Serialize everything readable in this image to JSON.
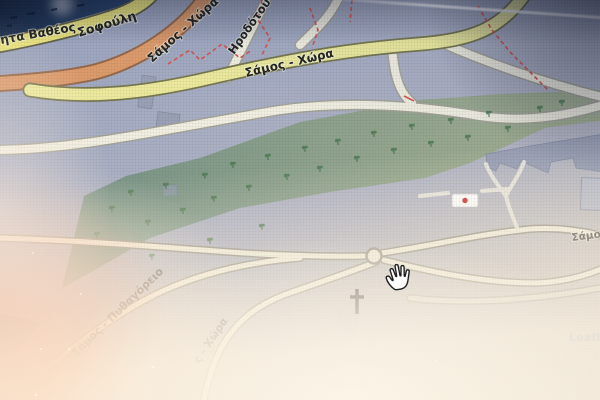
{
  "map": {
    "attribution": "Leaflet",
    "cursor": "open-hand-grab",
    "labels": {
      "coast_partial": "ητα Βαθέος",
      "sofouli": "Σοφούλη",
      "primary_road": "Σάμος - Χώρα",
      "irodotou": "Ηροδότου",
      "secondary_road": "Σάμος - Χώρα",
      "samos_edge": "Σάμος",
      "pythagoreio_road": "Σάμος - Πυθαγόρειο",
      "chora_partial": "ς - Χώρα"
    },
    "colors": {
      "water": "#2e4a78",
      "water_deep": "#14223d",
      "road_coast": "#e9e27e",
      "road_coast_casing": "#5f5f47",
      "road_primary": "#dd9a6b",
      "road_primary_casing": "#96684a",
      "road_secondary": "#edea9d",
      "road_secondary_casing": "#77774f",
      "road_minor": "#f2efe2",
      "road_minor_casing": "#a5a49a",
      "forest_dark": "#568060",
      "forest_light": "#99ad66",
      "building": "#9aa0b6",
      "path_red": "#d9534f",
      "poi_marker_red": "#cc2222",
      "cross_black": "#1c1c1c",
      "attribution_blue": "#7b8fd4"
    },
    "forest": {
      "tree_positions": [
        [
          97,
          236
        ],
        [
          112,
          210
        ],
        [
          131,
          194
        ],
        [
          148,
          224
        ],
        [
          166,
          187
        ],
        [
          183,
          212
        ],
        [
          152,
          258
        ],
        [
          205,
          177
        ],
        [
          214,
          200
        ],
        [
          233,
          166
        ],
        [
          249,
          189
        ],
        [
          210,
          242
        ],
        [
          262,
          228
        ],
        [
          268,
          158
        ],
        [
          287,
          178
        ],
        [
          305,
          150
        ],
        [
          320,
          170
        ],
        [
          338,
          143
        ],
        [
          357,
          160
        ],
        [
          374,
          135
        ],
        [
          394,
          152
        ],
        [
          412,
          128
        ],
        [
          431,
          145
        ],
        [
          451,
          122
        ],
        [
          468,
          139
        ],
        [
          489,
          115
        ],
        [
          508,
          130
        ],
        [
          540,
          110
        ],
        [
          562,
          104
        ]
      ]
    }
  }
}
